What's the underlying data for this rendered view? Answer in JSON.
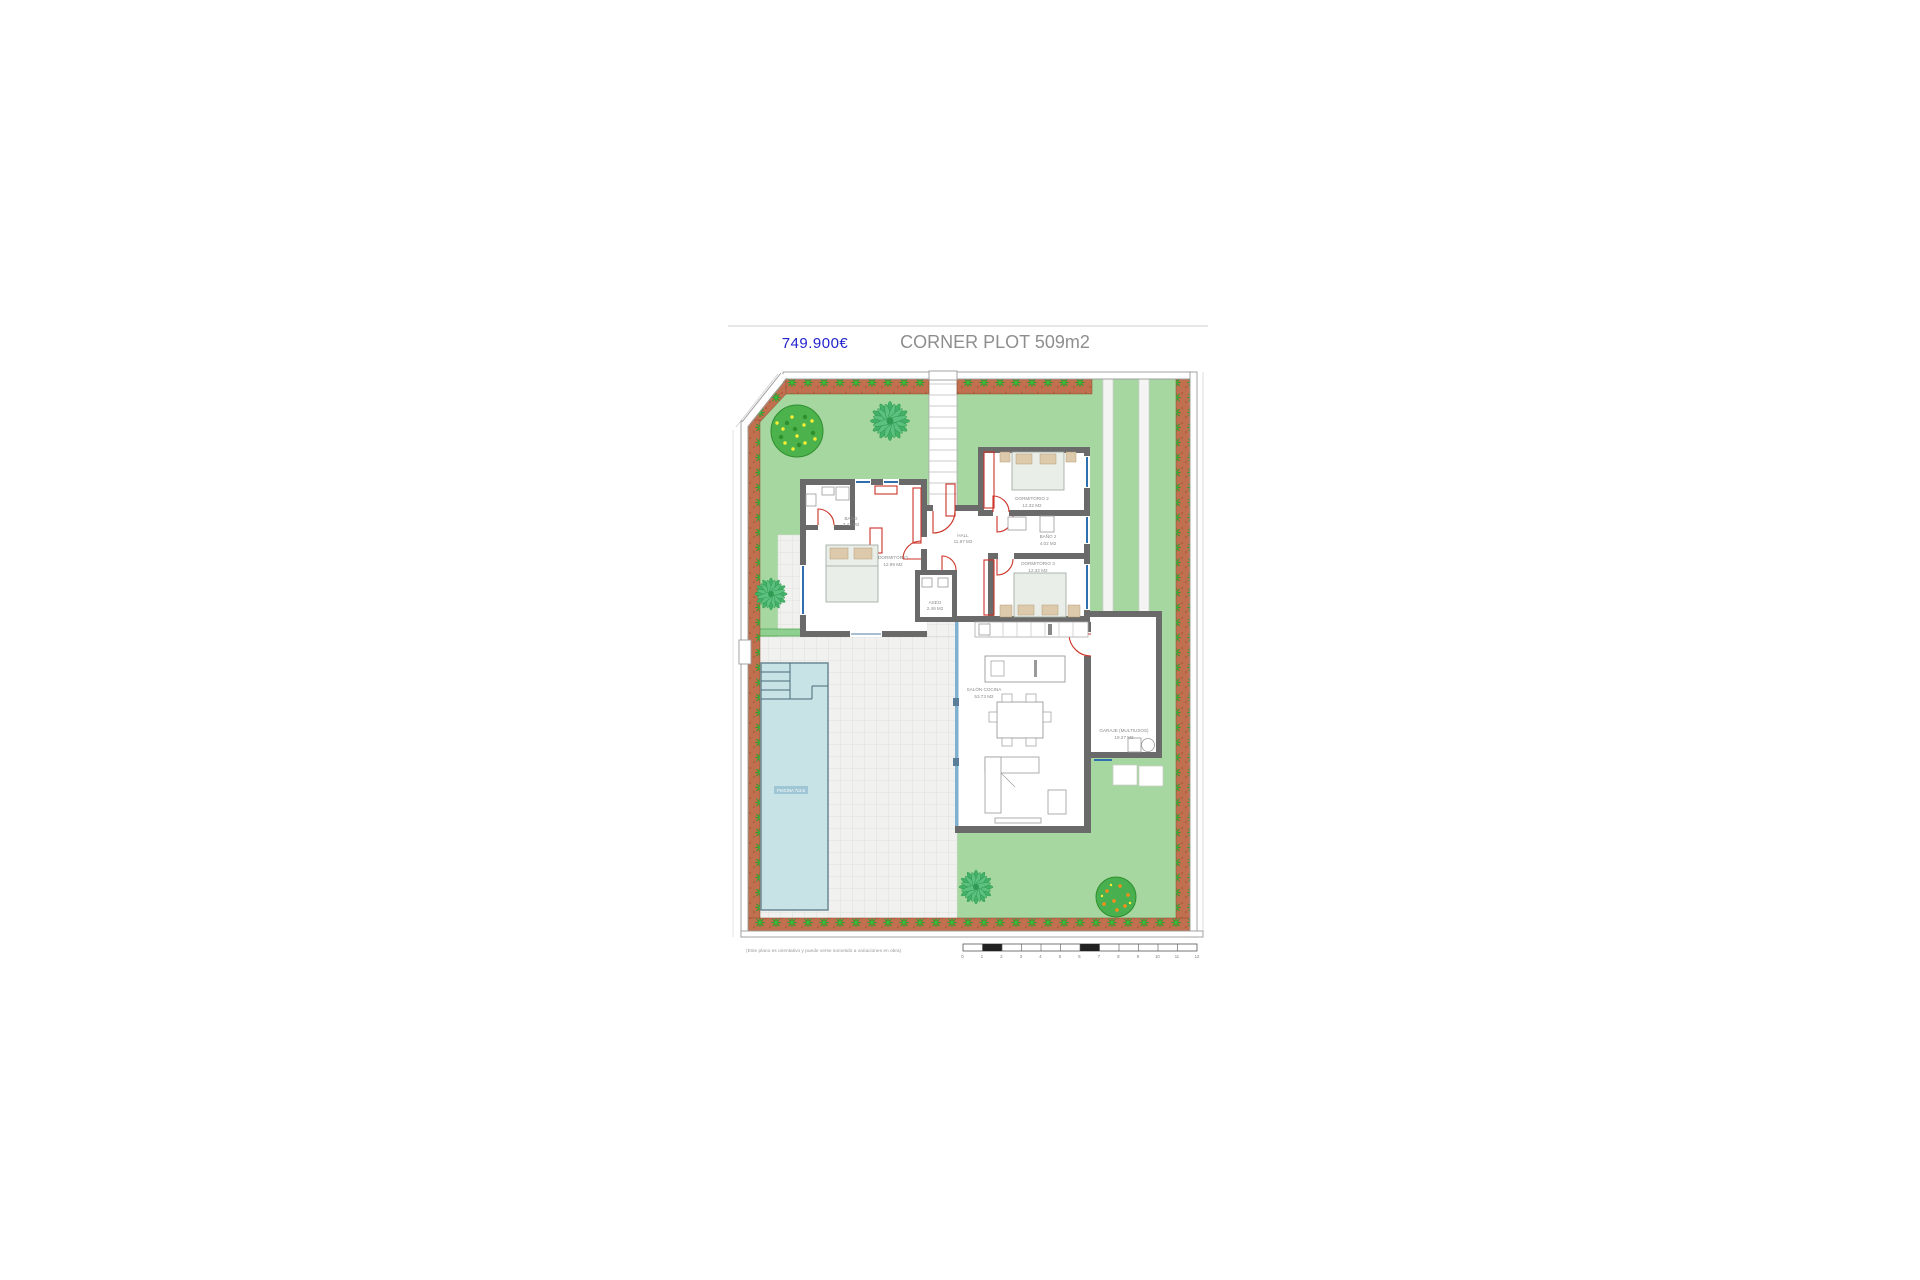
{
  "header": {
    "price": "749.900€",
    "title": "CORNER PLOT 509m2"
  },
  "rooms": [
    {
      "name": "BAÑO",
      "area": "3.43 M2"
    },
    {
      "name": "DORMITORIO",
      "area": "12.99 M2"
    },
    {
      "name": "HALL",
      "area": "11.97 M2"
    },
    {
      "name": "DORMITORIO 2",
      "area": "12.32 M2"
    },
    {
      "name": "BAÑO 2",
      "area": "4.02 M2"
    },
    {
      "name": "DORMITORIO 3",
      "area": "12.32 M2"
    },
    {
      "name": "ASEO",
      "area": "2.49 M2"
    },
    {
      "name": "SALÓN COCINA",
      "area": "53.73 M2"
    },
    {
      "name": "GARAJE (MULTIUSOS)",
      "area": "19.27 M2"
    }
  ],
  "pool": {
    "label": "PISCINA 7x3.5"
  },
  "footer": {
    "disclaimer": "(Este plano es orientativo y puede verse sometido a variaciones en obra)",
    "scale_numbers": [
      "0",
      "1",
      "2",
      "3",
      "4",
      "5",
      "6",
      "7",
      "8",
      "9",
      "10",
      "11",
      "12"
    ]
  },
  "colors": {
    "garden_green": "#a7d7a1",
    "border_terracotta": "#c0704e",
    "plant_green": "#1ea22e",
    "wall_gray": "#6a6a6a",
    "window_blue": "#2f6fae",
    "door_red": "#cc3226",
    "pool_blue": "#c7e3e6",
    "terrace_tile": "#f1f1ef",
    "price_blue": "#2222cc",
    "title_gray": "#8e8e8e"
  }
}
